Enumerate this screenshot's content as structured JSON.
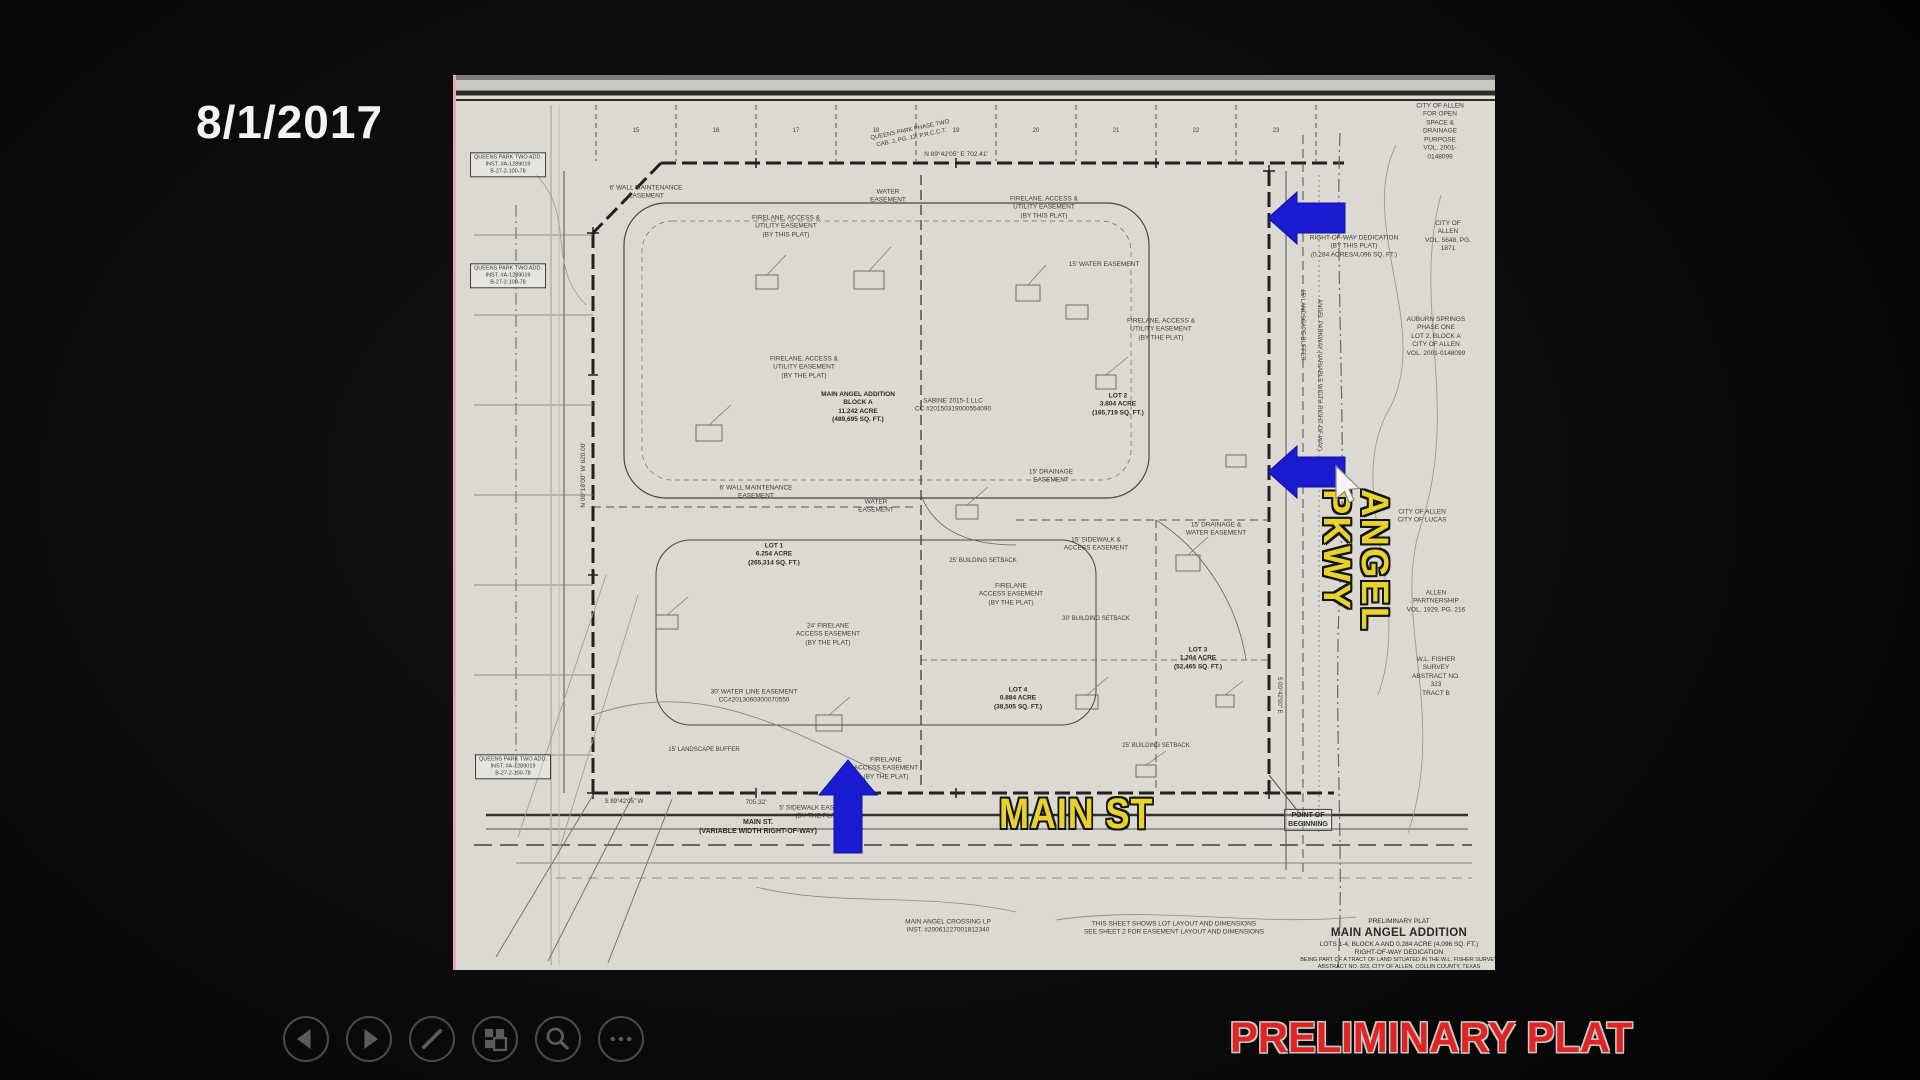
{
  "slide": {
    "date": "8/1/2017",
    "watermark": "PRELIMINARY PLAT"
  },
  "controls": {
    "items": [
      {
        "name": "previous-slide",
        "icon": "left-triangle-icon"
      },
      {
        "name": "next-slide",
        "icon": "right-triangle-icon"
      },
      {
        "name": "pen-tools",
        "icon": "pen-icon"
      },
      {
        "name": "see-all-slides",
        "icon": "slides-grid-icon"
      },
      {
        "name": "zoom",
        "icon": "magnifier-icon"
      },
      {
        "name": "more-options",
        "icon": "ellipsis-icon"
      }
    ]
  },
  "colors": {
    "background": "#0d0d0d",
    "sheet": "#dcd9d2",
    "arrow_blue": "#1b1bd2",
    "road_label_yellow": "#e8d22e",
    "watermark_red": "#e02424",
    "control_gray": "#5c5c55",
    "date_white": "#f3f3f3"
  },
  "plat": {
    "road_labels": {
      "main_st": "MAIN ST",
      "angel_pkwy": "ANGEL PKWY"
    },
    "title_block": {
      "l1": "PRELIMINARY PLAT",
      "l2": "MAIN ANGEL ADDITION",
      "l3": "LOTS 1-4, BLOCK A AND 0.284 ACRE (4,096 SQ. FT.)",
      "l4": "RIGHT-OF-WAY DEDICATION",
      "l5": "BEING PART OF A TRACT OF LAND SITUATED IN THE W.L. FISHER SURVEY",
      "l6": "ABSTRACT NO. 323, CITY OF ALLEN, COLLIN COUNTY, TEXAS"
    },
    "north_lot_numbers": [
      "15",
      "16",
      "17",
      "18",
      "19",
      "20",
      "21",
      "22",
      "23"
    ],
    "annotations": [
      {
        "x": 402,
        "y": 333,
        "b": 1,
        "t": "MAIN ANGEL ADDITION\nBLOCK A\n11.242 ACRE\n(489,695 SQ. FT.)"
      },
      {
        "x": 497,
        "y": 331,
        "t": "SABINE 2015-1 LLC\nCC #20150319000554090"
      },
      {
        "x": 662,
        "y": 330,
        "b": 1,
        "t": "LOT 2\n3.804 ACRE\n(165,719 SQ. FT.)"
      },
      {
        "x": 318,
        "y": 480,
        "b": 1,
        "t": "LOT 1\n6.254 ACRE\n(265,314 SQ. FT.)"
      },
      {
        "x": 562,
        "y": 624,
        "b": 1,
        "t": "LOT 4\n0.884 ACRE\n(38,505 SQ. FT.)"
      },
      {
        "x": 742,
        "y": 584,
        "b": 1,
        "t": "LOT 3\n1.204 ACRE\n(52,465 SQ. FT.)"
      },
      {
        "x": 302,
        "y": 752,
        "b": 1,
        "s": 7,
        "t": "MAIN ST.\n(VARIABLE WIDTH RIGHT-OF-WAY)"
      },
      {
        "x": 898,
        "y": 172,
        "t": "RIGHT-OF-WAY DEDICATION\n(BY THIS PLAT)\n(0.284 ACRES/4,096 SQ. FT.)"
      },
      {
        "x": 984,
        "y": 57,
        "t": "CITY OF ALLEN\nFOR OPEN SPACE &\nDRAINAGE PURPOSE\nVOL. 2001-0148099"
      },
      {
        "x": 992,
        "y": 162,
        "t": "CITY OF ALLEN\nVOL. 5648, PG. 1871"
      },
      {
        "x": 980,
        "y": 262,
        "t": "AUBURN SPRINGS\nPHASE ONE\nLOT 2, BLOCK A\nCITY OF ALLEN\nVOL. 2001-0148099"
      },
      {
        "x": 966,
        "y": 442,
        "t": "CITY OF ALLEN\nCITY OF LUCAS"
      },
      {
        "x": 980,
        "y": 527,
        "t": "ALLEN PARTNERSHIP\nVOL. 1929, PG. 216"
      },
      {
        "x": 980,
        "y": 602,
        "t": "W.L. FISHER SURVEY\nABSTRACT NO. 323\nTRACT B"
      },
      {
        "x": 852,
        "y": 745,
        "b": 1,
        "box": 1,
        "s": 7,
        "t": "POINT OF\nBEGINNING"
      },
      {
        "x": 718,
        "y": 854,
        "t": "THIS SHEET SHOWS LOT LAYOUT AND DIMENSIONS\nSEE SHEET 2 FOR EASEMENT LAYOUT AND DIMENSIONS"
      },
      {
        "x": 492,
        "y": 852,
        "t": "MAIN ANGEL CROSSING LP\nINST. #20061227001812340"
      },
      {
        "x": 52,
        "y": 90,
        "box": 1,
        "s": 5.5,
        "t": "QUEENS PARK TWO ADD.\nINST. #A-1289019\nB-27-2-100-78"
      },
      {
        "x": 52,
        "y": 201,
        "box": 1,
        "s": 5.5,
        "t": "QUEENS PARK TWO ADD.\nINST. #A-1289019\nB-27-2-100-78"
      },
      {
        "x": 57,
        "y": 692,
        "box": 1,
        "s": 5.5,
        "t": "QUEENS PARK TWO ADD.\nINST. #A-1289019\nB-27-2-100-78"
      },
      {
        "x": 455,
        "y": 60,
        "r": -12,
        "s": 6,
        "t": "QUEENS PARK PHASE TWO\nCAB. J, PG. 12, P.R.C.C.T."
      },
      {
        "x": 500,
        "y": 80,
        "s": 6.5,
        "t": "N 89°42'05\" E   702.41'"
      },
      {
        "x": 300,
        "y": 728,
        "s": 6.5,
        "t": "705.32'"
      },
      {
        "x": 168,
        "y": 728,
        "s": 6,
        "t": "S 89°42'05\" W"
      },
      {
        "x": 128,
        "y": 400,
        "r": -90,
        "s": 6.5,
        "t": "N 00°18'00\" W   620.00'"
      },
      {
        "x": 822,
        "y": 620,
        "r": 90,
        "s": 6,
        "t": "S 00°42'00\" E"
      },
      {
        "x": 862,
        "y": 300,
        "r": 90,
        "s": 6,
        "t": "ANGEL PARKWAY  (VARIABLE WIDTH RIGHT-OF-WAY)"
      },
      {
        "x": 190,
        "y": 118,
        "t": "6' WALL MAINTENANCE\nEASEMENT"
      },
      {
        "x": 330,
        "y": 152,
        "t": "FIRELANE, ACCESS &\nUTILITY EASEMENT\n(BY THIS PLAT)"
      },
      {
        "x": 432,
        "y": 122,
        "t": "WATER\nEASEMENT"
      },
      {
        "x": 588,
        "y": 133,
        "t": "FIRELANE, ACCESS &\nUTILITY EASEMENT\n(BY THIS PLAT)"
      },
      {
        "x": 648,
        "y": 190,
        "t": "15' WATER EASEMENT"
      },
      {
        "x": 705,
        "y": 255,
        "t": "FIRELANE, ACCESS &\nUTILITY EASEMENT\n(BY THE PLAT)"
      },
      {
        "x": 348,
        "y": 293,
        "t": "FIRELANE, ACCESS &\nUTILITY EASEMENT\n(BY THE PLAT)"
      },
      {
        "x": 300,
        "y": 418,
        "t": "6' WALL MAINTENANCE\nEASEMENT"
      },
      {
        "x": 420,
        "y": 432,
        "t": "WATER\nEASEMENT"
      },
      {
        "x": 595,
        "y": 402,
        "t": "15' DRAINAGE\nEASEMENT"
      },
      {
        "x": 640,
        "y": 470,
        "t": "15' SIDEWALK &\nACCESS EASEMENT"
      },
      {
        "x": 555,
        "y": 520,
        "t": "FIRELANE\nACCESS EASEMENT\n(BY THE PLAT)"
      },
      {
        "x": 372,
        "y": 560,
        "t": "24' FIRELANE\nACCESS EASEMENT\n(BY THE PLAT)"
      },
      {
        "x": 298,
        "y": 622,
        "t": "30' WATER LINE EASEMENT\nCC#2013060300070550"
      },
      {
        "x": 248,
        "y": 676,
        "s": 6,
        "t": "15' LANDSCAPE BUFFER"
      },
      {
        "x": 430,
        "y": 694,
        "t": "FIRELANE\nACCESS EASEMENT\n(BY THE PLAT)"
      },
      {
        "x": 362,
        "y": 738,
        "t": "5' SIDEWALK EASEMENT\n(BY THE PLAT)"
      },
      {
        "x": 760,
        "y": 455,
        "t": "15' DRAINAGE &\nWATER EASEMENT"
      },
      {
        "x": 527,
        "y": 487,
        "s": 6,
        "t": "25' BUILDING SETBACK"
      },
      {
        "x": 640,
        "y": 545,
        "s": 6,
        "t": "30' BUILDING SETBACK"
      },
      {
        "x": 845,
        "y": 250,
        "r": 90,
        "s": 6,
        "t": "15' LANDSCAPE BUFFER"
      },
      {
        "x": 700,
        "y": 672,
        "s": 6,
        "t": "25' BUILDING SETBACK"
      }
    ]
  }
}
